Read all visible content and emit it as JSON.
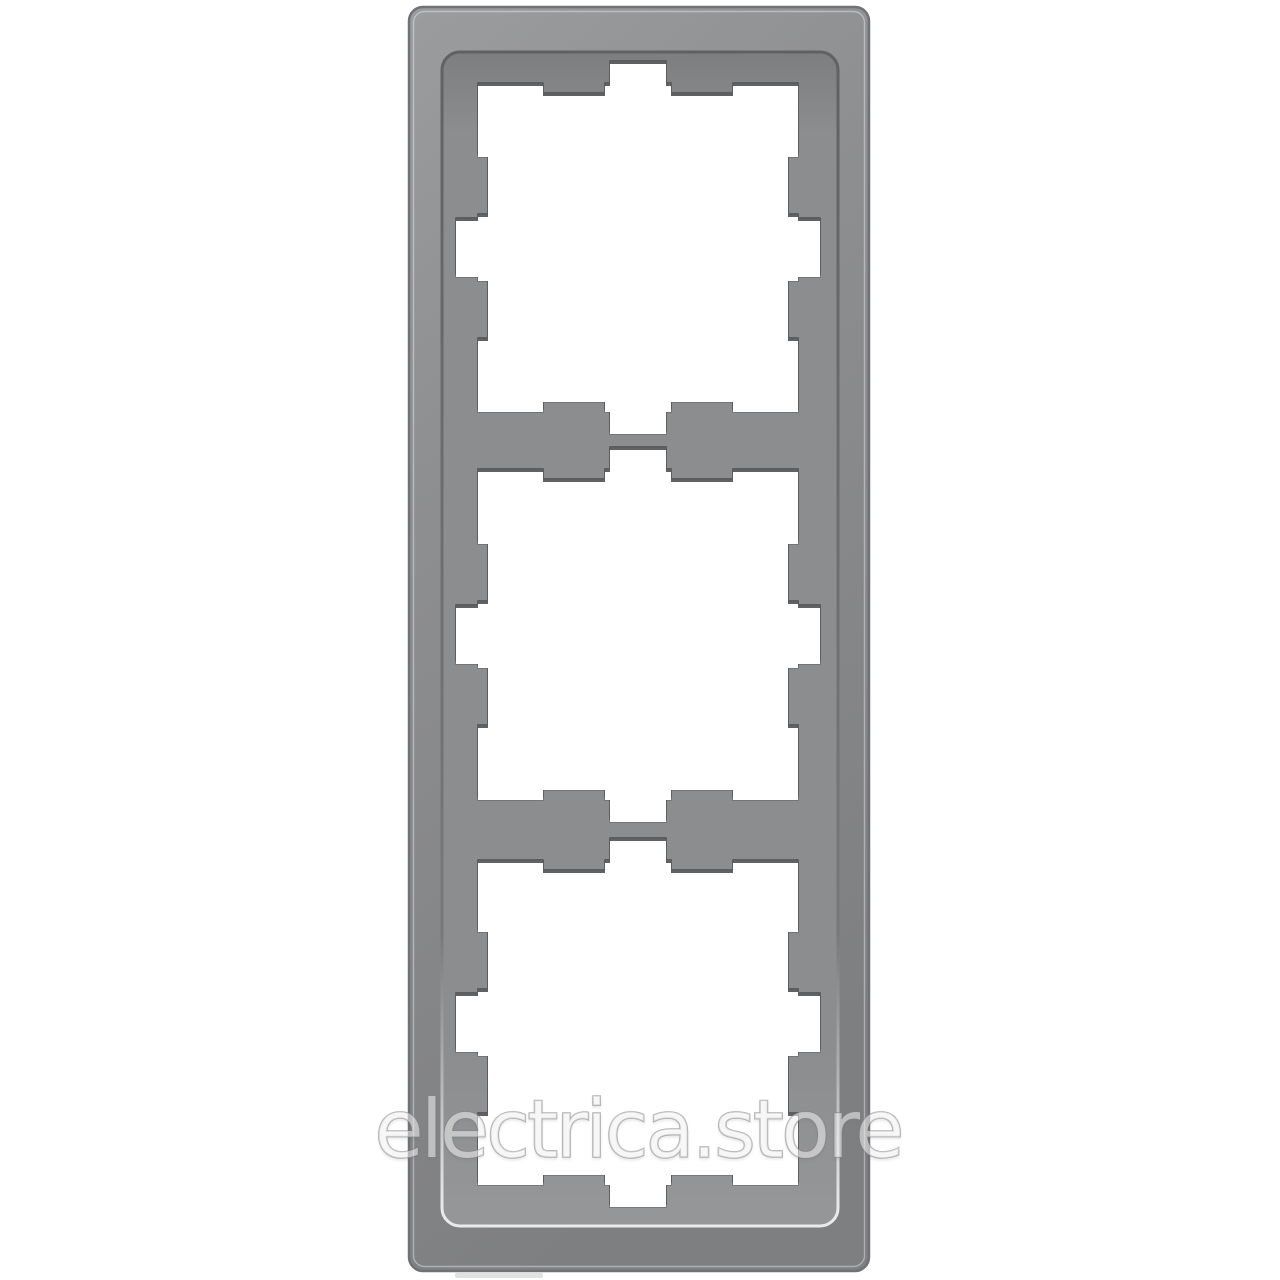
{
  "image": {
    "subject": "three-gang rectangular wall switch frame, grey stainless look, portrait orientation on white background"
  },
  "watermark": {
    "text": "electrica.store"
  },
  "colors": {
    "background": "#ffffff",
    "frame_light": "#9b9c9e",
    "frame_base": "#8e8f91",
    "frame_dark": "#7e7f81",
    "frame_outline": "#717275",
    "bevel_highlight": "rgba(255,255,255,0.38)",
    "recess_top_shadow": "#7d7e80",
    "recess_base": "#8c8d8f",
    "recess_light": "#969799",
    "wall_dark": "#606163",
    "wall_mid": "#777879",
    "wall_light": "#e9eaeb",
    "edge_shadow": "#5c5d5f",
    "opening_fill": "#ffffff",
    "opening_rim": "rgba(92,93,95,0.5)",
    "watermark_fill": "rgba(255,255,255,0.5)",
    "watermark_stroke": "rgba(128,129,131,0.6)",
    "edge_marking": "#d6d7d9"
  }
}
